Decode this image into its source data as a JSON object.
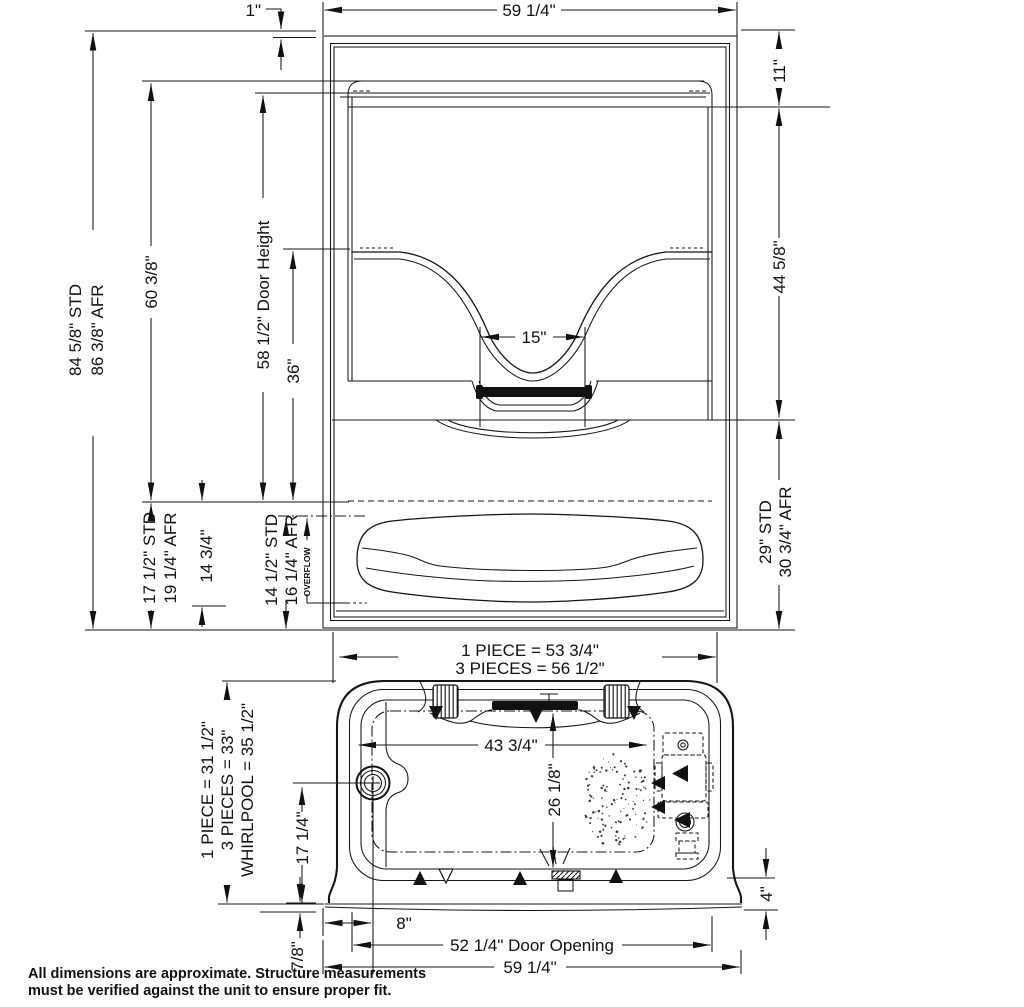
{
  "note": {
    "line1": "All dimensions are approximate. Structure measurements",
    "line2": "must be verified against the unit to ensure proper fit."
  },
  "elevation": {
    "dims": {
      "top_offset": "1\"",
      "overall_width": "59 1/4\"",
      "top_right": "11\"",
      "mid_right": "44 5/8\"",
      "bottom_right_std": "29\" STD",
      "bottom_right_afr": "30 3/4\" AFR",
      "left_std": "84 5/8\" STD",
      "left_afr": "86 3/8\" AFR",
      "interior_height": "60 3/8\"",
      "door_height": "58 1/2\" Door Height",
      "seat_back": "36\"",
      "grab_bar": "15\"",
      "deck_std": "17 1/2\" STD",
      "deck_afr": "19 1/4\" AFR",
      "apron_height": "14 3/4\"",
      "overflow_std": "14 1/2\" STD",
      "overflow_afr": "16 1/4\" AFR",
      "overflow": "OVERFLOW"
    }
  },
  "plan": {
    "dims": {
      "width_one_piece": "1 PIECE = 53 3/4\"",
      "width_three_pieces": "3 PIECES = 56 1/2\"",
      "depth_one_piece": "1 PIECE = 31 1/2\"",
      "depth_three_pieces": "3 PIECES = 33\"",
      "depth_whirlpool": "WHIRLPOOL = 35 1/2\"",
      "interior_width": "43 3/4\"",
      "drain_from_back": "26 1/8\"",
      "drain_height": "17 1/4\"",
      "drain_offset": "8\"",
      "door_opening": "52 1/4\" Door Opening",
      "overall_width": "59 1/4\"",
      "flange": "7/8\"",
      "apron_gap": "4\""
    }
  }
}
